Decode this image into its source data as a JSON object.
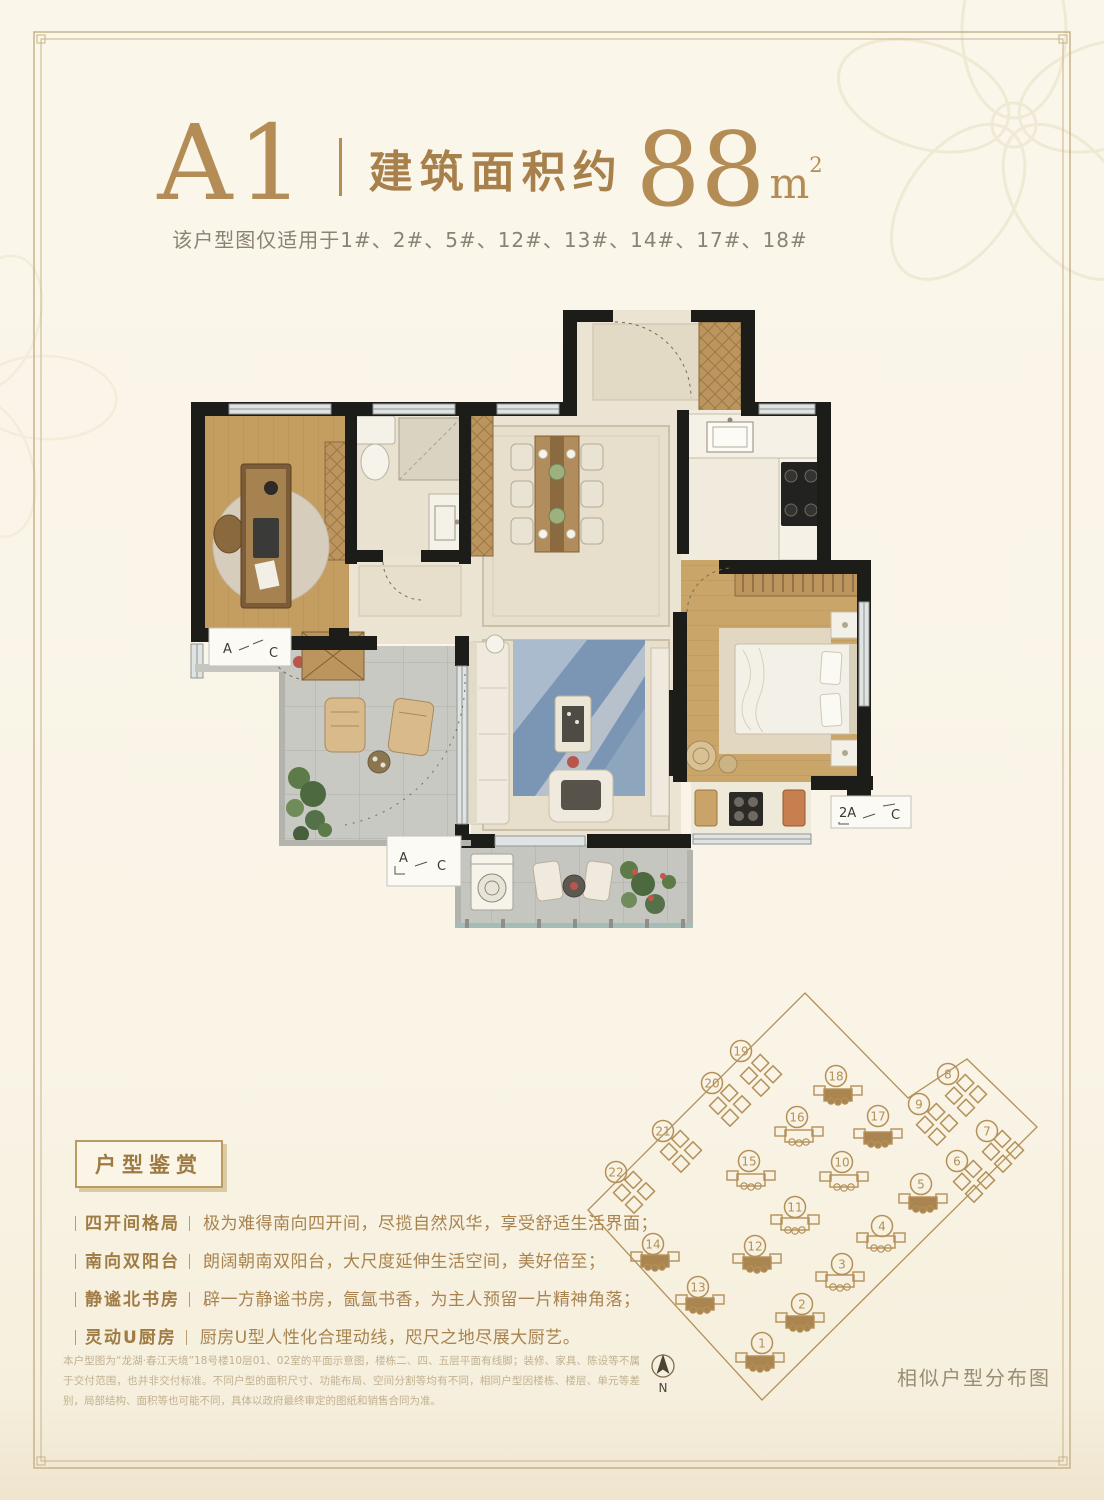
{
  "header": {
    "unit_code": "A1",
    "area_prefix": "建筑面积约",
    "area_value": "88",
    "area_unit": "m",
    "area_exp": "2",
    "applicability": "该户型图仅适用于1#、2#、5#、12#、13#、14#、17#、18#"
  },
  "floorplan": {
    "ac_labels": [
      {
        "a": "A",
        "c": "C"
      },
      {
        "a": "A",
        "c": "C"
      },
      {
        "a": "2A",
        "c": "C"
      }
    ]
  },
  "features": {
    "badge": "户型鉴赏",
    "items": [
      {
        "label": "四开间格局",
        "text": "极为难得南向四开间，尽揽自然风华，享受舒适生活界面；"
      },
      {
        "label": "南向双阳台",
        "text": "朗阔朝南双阳台，大尺度延伸生活空间，美好倍至；"
      },
      {
        "label": "静谧北书房",
        "text": "辟一方静谧书房，氤氲书香，为主人预留一片精神角落；"
      },
      {
        "label": "灵动U厨房",
        "text": "厨房U型人性化合理动线，咫尺之地尽展大厨艺。"
      }
    ]
  },
  "disclaimer": "本户型图为“龙湖·春江天境”18号楼10层01、02室的平面示意图，楼栋二、四、五层平面有线脚；装修、家具、陈设等不属于交付范围，也并非交付标准。不同户型的面积尺寸、功能布局、空间分割等均有不同，相同户型因楼栋、楼层、单元等差别，局部结构、面积等也可能不同，具体以政府最终审定的图纸和销售合同为准。",
  "siteplan": {
    "caption": "相似户型分布图",
    "compass_label": "N",
    "line_color": "#b49058",
    "fill_color": "#ab8550",
    "highlighted_buildings": [
      "1",
      "2",
      "5",
      "12",
      "13",
      "14",
      "17",
      "18"
    ],
    "buildings": [
      {
        "n": "1",
        "cx": 187,
        "cy": 358,
        "bx": 185,
        "by": 377,
        "type": "slab",
        "filled": true
      },
      {
        "n": "2",
        "cx": 227,
        "cy": 319,
        "bx": 225,
        "by": 337,
        "type": "slab",
        "filled": true
      },
      {
        "n": "3",
        "cx": 267,
        "cy": 279,
        "bx": 265,
        "by": 296,
        "type": "slab",
        "filled": false
      },
      {
        "n": "4",
        "cx": 307,
        "cy": 241,
        "bx": 306,
        "by": 257,
        "type": "slab",
        "filled": false
      },
      {
        "n": "5",
        "cx": 346,
        "cy": 199,
        "bx": 348,
        "by": 218,
        "type": "slab",
        "filled": true
      },
      {
        "n": "6",
        "cx": 382,
        "cy": 176,
        "bx": 399,
        "by": 196,
        "type": "tower",
        "filled": false
      },
      {
        "n": "7",
        "cx": 412,
        "cy": 146,
        "bx": 428,
        "by": 166,
        "type": "tower",
        "filled": false
      },
      {
        "n": "8",
        "cx": 373,
        "cy": 89,
        "bx": 391,
        "by": 110,
        "type": "tower",
        "filled": false
      },
      {
        "n": "9",
        "cx": 344,
        "cy": 119,
        "bx": 362,
        "by": 139,
        "type": "tower",
        "filled": false
      },
      {
        "n": "10",
        "cx": 267,
        "cy": 177,
        "bx": 269,
        "by": 196,
        "type": "slab",
        "filled": false
      },
      {
        "n": "11",
        "cx": 220,
        "cy": 222,
        "bx": 220,
        "by": 239,
        "type": "slab",
        "filled": false
      },
      {
        "n": "12",
        "cx": 180,
        "cy": 261,
        "bx": 182,
        "by": 278,
        "type": "slab",
        "filled": true
      },
      {
        "n": "13",
        "cx": 123,
        "cy": 302,
        "bx": 125,
        "by": 319,
        "type": "slab",
        "filled": true
      },
      {
        "n": "14",
        "cx": 78,
        "cy": 259,
        "bx": 80,
        "by": 276,
        "type": "slab",
        "filled": true
      },
      {
        "n": "15",
        "cx": 174,
        "cy": 176,
        "bx": 176,
        "by": 195,
        "type": "slab",
        "filled": false
      },
      {
        "n": "16",
        "cx": 222,
        "cy": 132,
        "bx": 224,
        "by": 151,
        "type": "slab",
        "filled": false
      },
      {
        "n": "17",
        "cx": 303,
        "cy": 131,
        "bx": 303,
        "by": 153,
        "type": "slab",
        "filled": true
      },
      {
        "n": "18",
        "cx": 261,
        "cy": 91,
        "bx": 263,
        "by": 110,
        "type": "slab",
        "filled": true
      },
      {
        "n": "19",
        "cx": 166,
        "cy": 66,
        "bx": 186,
        "by": 90,
        "type": "tower",
        "filled": false
      },
      {
        "n": "20",
        "cx": 137,
        "cy": 98,
        "bx": 155,
        "by": 120,
        "type": "tower",
        "filled": false
      },
      {
        "n": "21",
        "cx": 88,
        "cy": 146,
        "bx": 106,
        "by": 166,
        "type": "tower",
        "filled": false
      },
      {
        "n": "22",
        "cx": 41,
        "cy": 187,
        "bx": 59,
        "by": 207,
        "type": "tower",
        "filled": false
      }
    ]
  }
}
